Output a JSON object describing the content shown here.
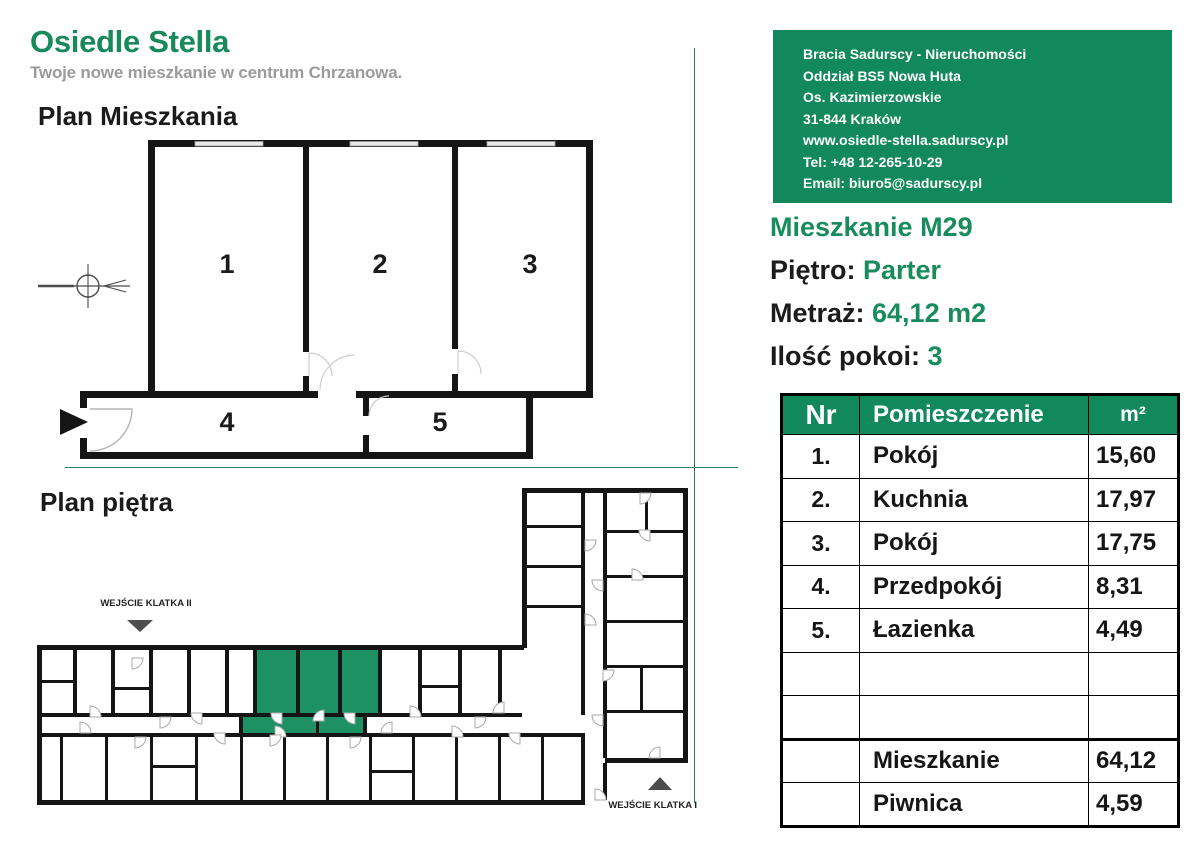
{
  "brand": {
    "title": "Osiedle Stella",
    "subtitle": "Twoje nowe mieszkanie w centrum Chrzanowa."
  },
  "sections": {
    "apartment_plan_heading": "Plan Mieszkania",
    "floor_plan_heading": "Plan piętra"
  },
  "contact": {
    "lines": [
      "Bracia Sadurscy - Nieruchomości",
      "Oddział BS5 Nowa Huta",
      "Os. Kazimierzowskie",
      "31-844 Kraków",
      "www.osiedle-stella.sadurscy.pl",
      "Tel: +48 12-265-10-29",
      "Email: biuro5@sadurscy.pl"
    ]
  },
  "apartment": {
    "name": "Mieszkanie M29",
    "floor_label": "Piętro: ",
    "floor_value": "Parter",
    "area_label": "Metraż: ",
    "area_value": "64,12 m2",
    "rooms_label": "Ilość pokoi: ",
    "rooms_value": "3"
  },
  "plan": {
    "room_numbers": [
      "1",
      "2",
      "3",
      "4",
      "5"
    ],
    "entrance_2_label": "WEJŚCIE KLATKA II",
    "entrance_1_label": "WEJŚCIE KLATKA I"
  },
  "table": {
    "headers": [
      "Nr",
      "Pomieszczenie",
      "m²"
    ],
    "rows": [
      {
        "nr": "1.",
        "name": "Pokój",
        "area": "15,60"
      },
      {
        "nr": "2.",
        "name": "Kuchnia",
        "area": "17,97"
      },
      {
        "nr": "3.",
        "name": "Pokój",
        "area": "17,75"
      },
      {
        "nr": "4.",
        "name": "Przedpokój",
        "area": "8,31"
      },
      {
        "nr": "5.",
        "name": "Łazienka",
        "area": "4,49"
      },
      {
        "nr": "",
        "name": "",
        "area": ""
      },
      {
        "nr": "",
        "name": "",
        "area": ""
      },
      {
        "nr": "",
        "name": "Mieszkanie",
        "area": "64,12"
      },
      {
        "nr": "",
        "name": "Piwnica",
        "area": "4,59"
      }
    ]
  },
  "colors": {
    "brand_green": "#12895c",
    "plan_highlight_green": "#1d9064",
    "wall_black": "#151515",
    "entrance_triangle_gray": "#4d4d4d"
  }
}
